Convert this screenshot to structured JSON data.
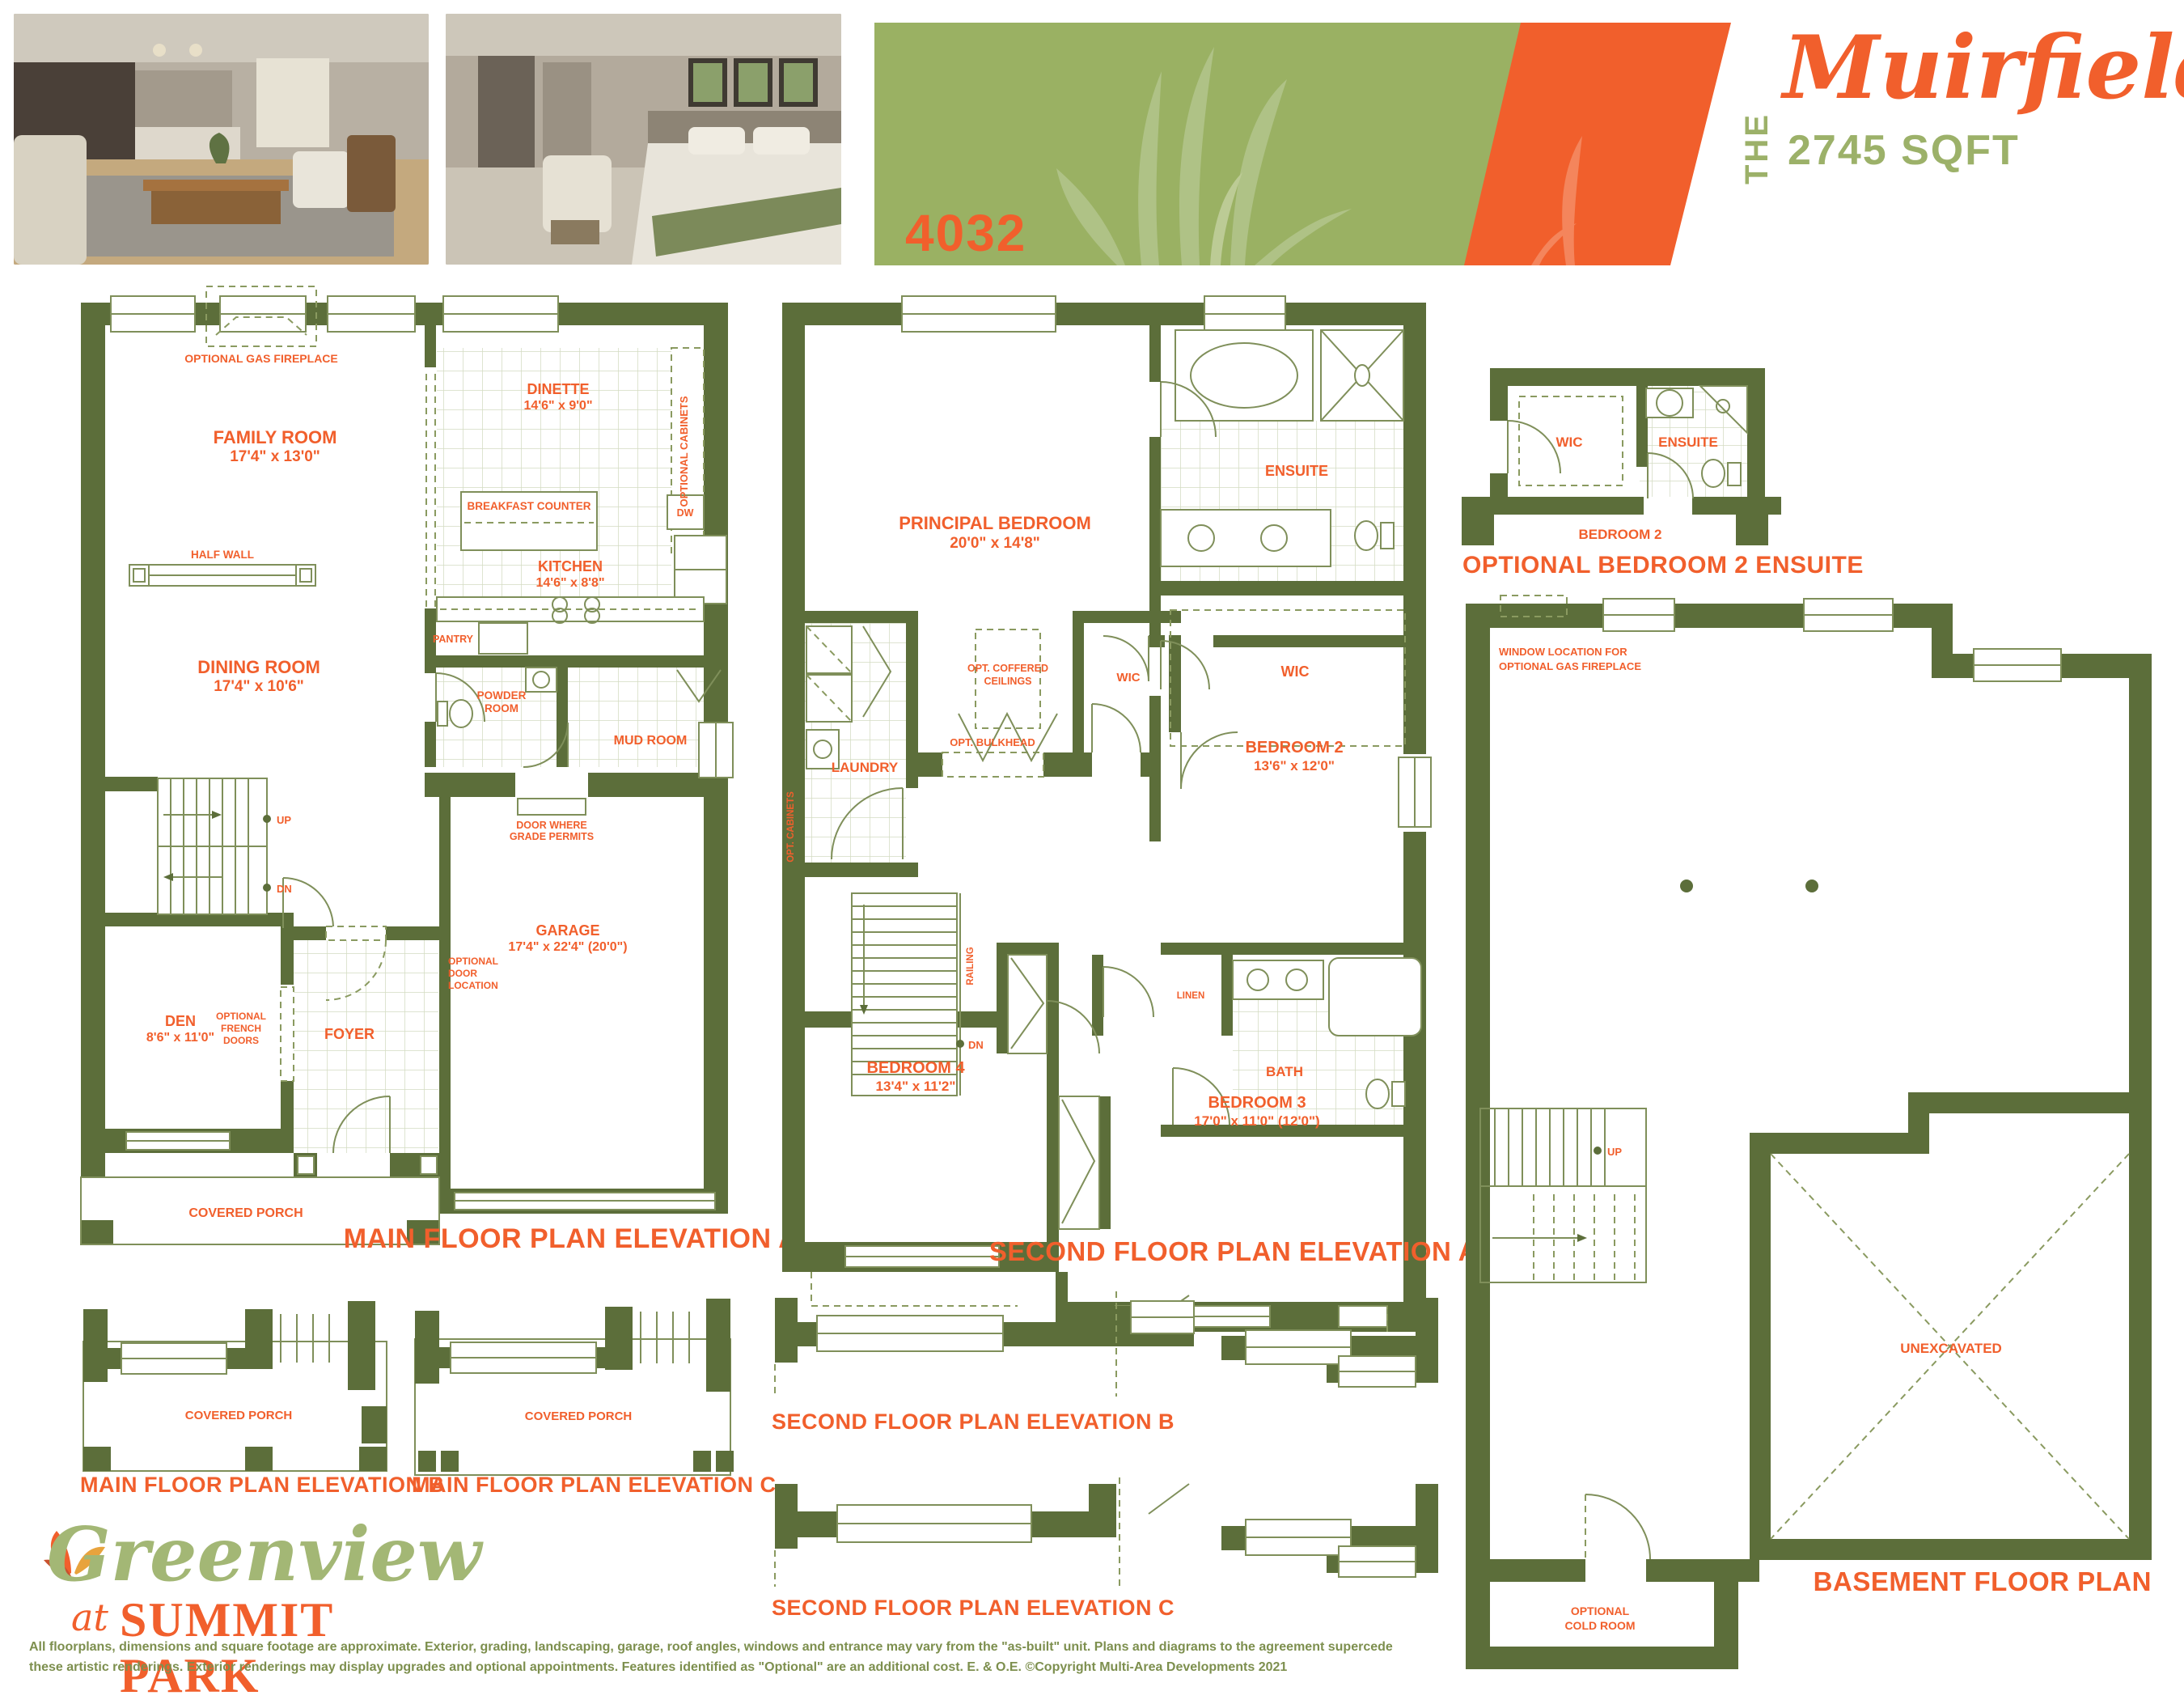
{
  "header": {
    "model_number": "4032",
    "series_prefix": "THE",
    "series_name": "Muirfield",
    "sqft": "2745 SQFT"
  },
  "photos": {
    "first_alt": "Living room interior rendering",
    "second_alt": "Bedroom interior rendering"
  },
  "colors": {
    "wall_olive": "#5C6E3A",
    "accent_orange": "#F15F2C",
    "banner_green": "#9AB163",
    "banner_light_green": "#AABF77",
    "light_green_text": "#9CB169",
    "disclaimer_green": "#7D8F4E"
  },
  "main_floor_a": {
    "title": "MAIN FLOOR PLAN ELEVATION A",
    "optional_gas_fireplace": "OPTIONAL GAS FIREPLACE",
    "family_room": "FAMILY ROOM",
    "family_room_dims": "17'4\" x 13'0\"",
    "dinette": "DINETTE",
    "dinette_dims": "14'6\" x 9'0\"",
    "optional_cabinets": "OPTIONAL CABINETS",
    "breakfast_counter": "BREAKFAST COUNTER",
    "dw": "DW",
    "kitchen": "KITCHEN",
    "kitchen_dims": "14'6\" x 8'8\"",
    "half_wall": "HALF WALL",
    "pantry": "PANTRY",
    "dining_room": "DINING ROOM",
    "dining_room_dims": "17'4\" x 10'6\"",
    "powder_l1": "POWDER",
    "powder_l2": "ROOM",
    "mud_room": "MUD ROOM",
    "door_grade_l1": "DOOR WHERE",
    "door_grade_l2": "GRADE PERMITS",
    "up": "UP",
    "dn": "DN",
    "den": "DEN",
    "den_dims": "8'6\" x 11'0\"",
    "opt_french_l1": "OPTIONAL",
    "opt_french_l2": "FRENCH",
    "opt_french_l3": "DOORS",
    "foyer": "FOYER",
    "opt_door_l1": "OPTIONAL",
    "opt_door_l2": "DOOR",
    "opt_door_l3": "LOCATION",
    "garage": "GARAGE",
    "garage_dims": "17'4\" x 22'4\" (20'0\")",
    "covered_porch": "COVERED PORCH"
  },
  "second_floor_a": {
    "title": "SECOND FLOOR PLAN ELEVATION A",
    "principal": "PRINCIPAL BEDROOM",
    "principal_dims": "20'0\" x 14'8\"",
    "ensuite": "ENSUITE",
    "wic": "WIC",
    "opt_bulkhead": "OPT. BULKHEAD",
    "opt_coffered_l1": "OPT. COFFERED",
    "opt_coffered_l2": "CEILINGS",
    "wic2": "WIC",
    "bedroom2": "BEDROOM 2",
    "bedroom2_dims": "13'6\" x 12'0\"",
    "laundry": "LAUNDRY",
    "opt_cabinets": "OPT. CABINETS",
    "railing": "RAILING",
    "dn": "DN",
    "linen": "LINEN",
    "bath": "BATH",
    "bedroom4": "BEDROOM 4",
    "bedroom4_dims": "13'4\" x 11'2\"",
    "bedroom3": "BEDROOM 3",
    "bedroom3_dims": "17'0\" x 11'0\" (12'0\")"
  },
  "optional_ensuite": {
    "title": "OPTIONAL BEDROOM 2 ENSUITE",
    "wic": "WIC",
    "ensuite": "ENSUITE",
    "bedroom2": "BEDROOM 2"
  },
  "basement": {
    "title": "BASEMENT FLOOR PLAN",
    "window_note_l1": "WINDOW LOCATION FOR",
    "window_note_l2": "OPTIONAL GAS FIREPLACE",
    "up": "UP",
    "unexcavated": "UNEXCAVATED",
    "cold_room_l1": "OPTIONAL",
    "cold_room_l2": "COLD ROOM"
  },
  "main_floor_b": {
    "title": "MAIN FLOOR PLAN ELEVATION B",
    "covered_porch": "COVERED PORCH"
  },
  "main_floor_c": {
    "title": "MAIN FLOOR PLAN ELEVATION C",
    "covered_porch": "COVERED PORCH"
  },
  "second_floor_b": {
    "title": "SECOND FLOOR PLAN ELEVATION B"
  },
  "second_floor_c": {
    "title": "SECOND FLOOR PLAN ELEVATION C"
  },
  "logo": {
    "script": "Greenview",
    "at": "at",
    "park": "SUMMIT PARK"
  },
  "disclaimer": {
    "line1": "All floorplans, dimensions and square footage are approximate. Exterior, grading, landscaping, garage, roof angles, windows and entrance may vary from the \"as-built\" unit. Plans and diagrams to the agreement supercede",
    "line2": "these artistic renderings. Exterior renderings may display upgrades and optional appointments. Features identified as \"Optional\" are an additional cost. E. & O.E. ©Copyright Multi-Area Developments 2021"
  }
}
